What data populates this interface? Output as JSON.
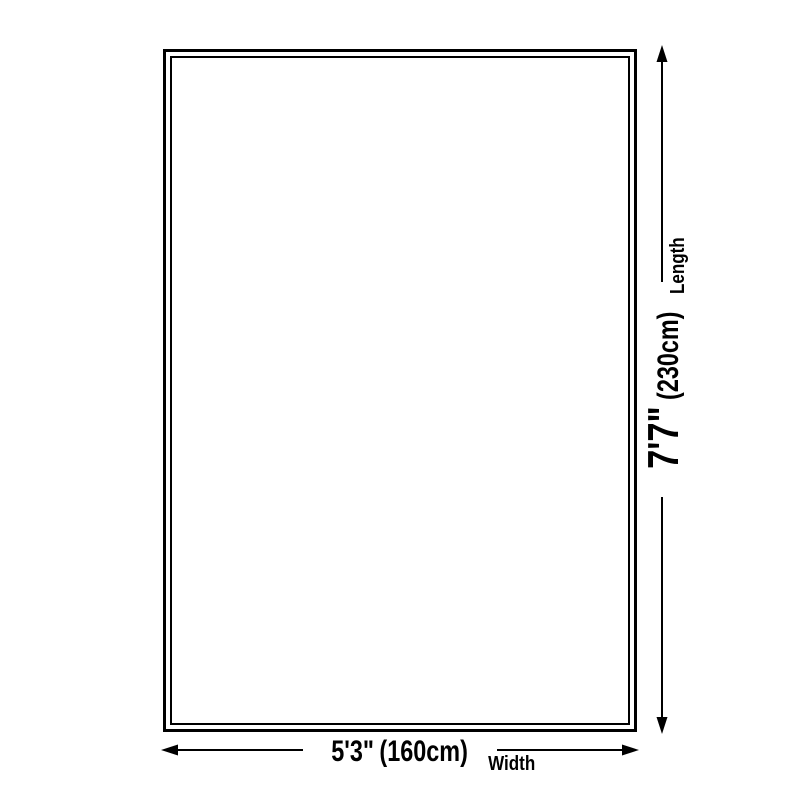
{
  "dimensions": {
    "length": {
      "axis_label": "Length",
      "imperial": "7'7\"",
      "metric": "(230cm)"
    },
    "width": {
      "axis_label": "Width",
      "imperial": "5'3\"",
      "metric": "(160cm)"
    }
  },
  "colors": {
    "line": "#000000",
    "background": "#ffffff"
  }
}
